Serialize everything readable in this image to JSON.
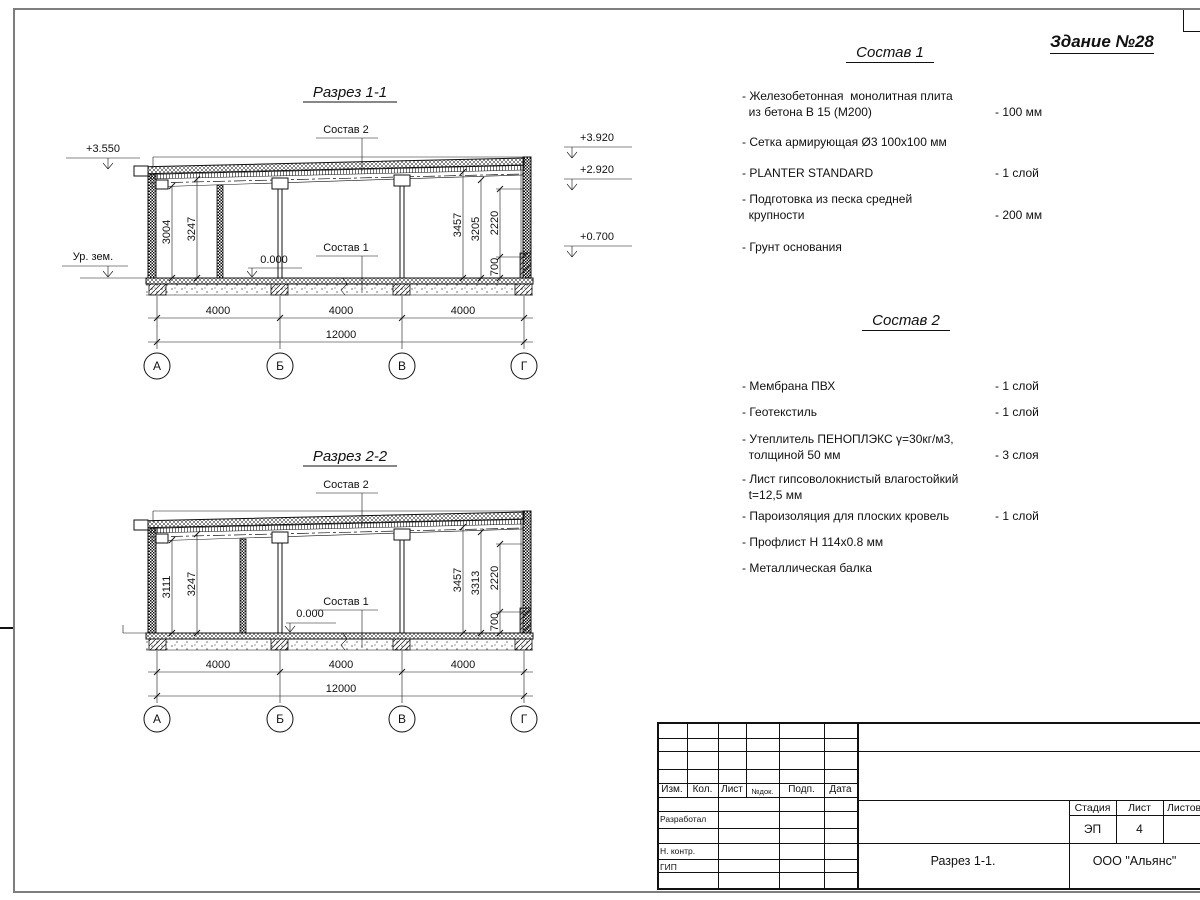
{
  "page": {
    "building_label": "Здание №28"
  },
  "sections": [
    {
      "title": "Разрез 1-1",
      "callout_top": "Состав 2",
      "callout_bottom": "Состав 1",
      "elev_canopy": "+3.550",
      "ground_label": "Ур. зем.",
      "elev_right": [
        "+3.920",
        "+2.920",
        "+0.700"
      ],
      "level_zero": "0.000",
      "dims_left": [
        "3004",
        "3247"
      ],
      "dims_right": [
        "3457",
        "3205",
        "2220",
        "700"
      ],
      "dims_span": [
        "4000",
        "4000",
        "4000"
      ],
      "dim_total": "12000",
      "axes": [
        "А",
        "Б",
        "В",
        "Г"
      ]
    },
    {
      "title": "Разрез 2-2",
      "callout_top": "Состав 2",
      "callout_bottom": "Состав 1",
      "level_zero": "0.000",
      "dims_left": [
        "3111",
        "3247"
      ],
      "dims_right": [
        "3457",
        "3313",
        "2220",
        "700"
      ],
      "dims_span": [
        "4000",
        "4000",
        "4000"
      ],
      "dim_total": "12000",
      "axes": [
        "А",
        "Б",
        "В",
        "Г"
      ]
    }
  ],
  "composition1": {
    "title": "Состав 1",
    "items": [
      {
        "text": "- Железобетонная  монолитная плита\n  из бетона В 15 (М200)",
        "value": "- 100 мм"
      },
      {
        "text": "- Сетка армирующая Ø3 100х100 мм",
        "value": ""
      },
      {
        "text": "- PLANTER STANDARD",
        "value": "- 1  слой"
      },
      {
        "text": "- Подготовка из песка средней\n  крупности",
        "value": "- 200 мм"
      },
      {
        "text": "- Грунт основания",
        "value": ""
      }
    ]
  },
  "composition2": {
    "title": "Состав 2",
    "items": [
      {
        "text": "- Мембрана ПВХ",
        "value": "- 1 слой"
      },
      {
        "text": "- Геотекстиль",
        "value": "- 1 слой"
      },
      {
        "text": "- Утеплитель ПЕНОПЛЭКС γ=30кг/м3,\n  толщиной 50 мм",
        "value": "- 3 слоя"
      },
      {
        "text": "- Лист гипсоволокнистый влагостойкий\n  t=12,5 мм",
        "value": ""
      },
      {
        "text": "- Пароизоляция для плоских кровель",
        "value": "- 1 слой"
      },
      {
        "text": "- Профлист Н 114х0.8 мм",
        "value": ""
      },
      {
        "text": "- Металлическая балка",
        "value": ""
      }
    ]
  },
  "title_block": {
    "col_headers": [
      "Изм.",
      "Кол.",
      "Лист",
      "№док.",
      "Подп.",
      "Дата"
    ],
    "row_labels": [
      "Разработал",
      "Н. контр.",
      "ГИП"
    ],
    "stage_header": "Стадия",
    "sheet_header": "Лист",
    "sheets_header": "Листов",
    "stage_value": "ЭП",
    "sheet_value": "4",
    "doc_title": "Разрез 1-1.",
    "company": "ООО \"Альянс\""
  }
}
